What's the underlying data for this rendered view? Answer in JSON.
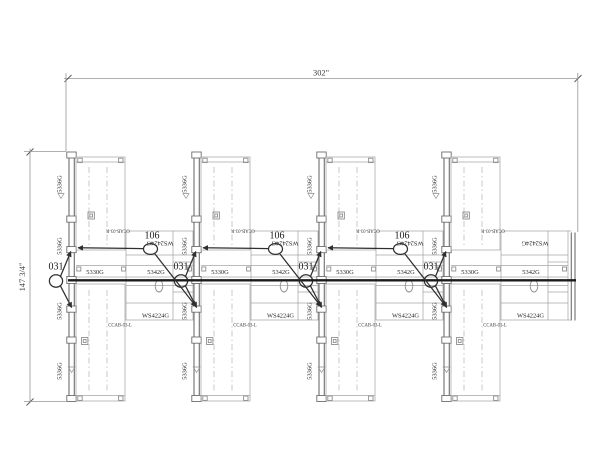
{
  "drawing": {
    "type": "furniture-installation-plan",
    "dim_width": "302\"",
    "dim_height": "147 3/4\"",
    "labels": {
      "tall_panel": "5336G",
      "panel_30": "5330G",
      "panel_42": "5342G",
      "ws_4224": "WS4224G",
      "ws_2424": "WS2424G",
      "cab_left": "CCAB-03-L",
      "cab_right": "CCAB-03-R",
      "callout_106": "106",
      "callout_031": "031"
    },
    "colors": {
      "line_dark": "#1b1b1b",
      "line_panel": "#6e6e6e",
      "line_furniture": "#a6a6a6",
      "background": "#ffffff"
    }
  }
}
